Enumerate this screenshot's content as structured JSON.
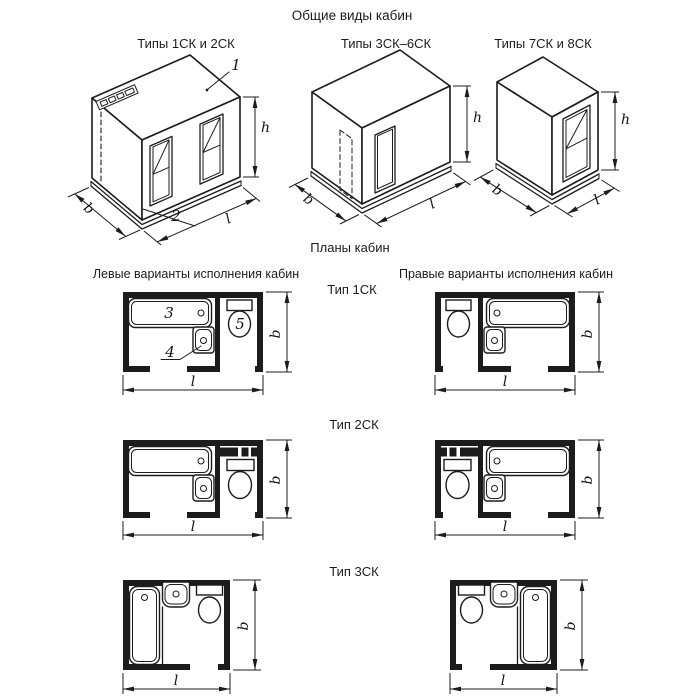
{
  "labels": {
    "title": "Общие виды кабин",
    "views": [
      "Типы 1СК и 2СК",
      "Типы 3СК–6СК",
      "Типы 7СК и 8СК"
    ],
    "plans_title": "Планы кабин",
    "left_variants": "Левые варианты исполнения кабин",
    "right_variants": "Правые варианты исполнения кабин",
    "types": [
      "Тип 1СК",
      "Тип 2СК",
      "Тип 3СК"
    ]
  },
  "dims": {
    "h": "h",
    "b": "b",
    "l": "l"
  },
  "callouts": {
    "c1": "1",
    "c2": "2",
    "c3": "3",
    "c4": "4",
    "c5": "5"
  },
  "colors": {
    "line": "#1c1c1c",
    "background": "#ffffff"
  }
}
